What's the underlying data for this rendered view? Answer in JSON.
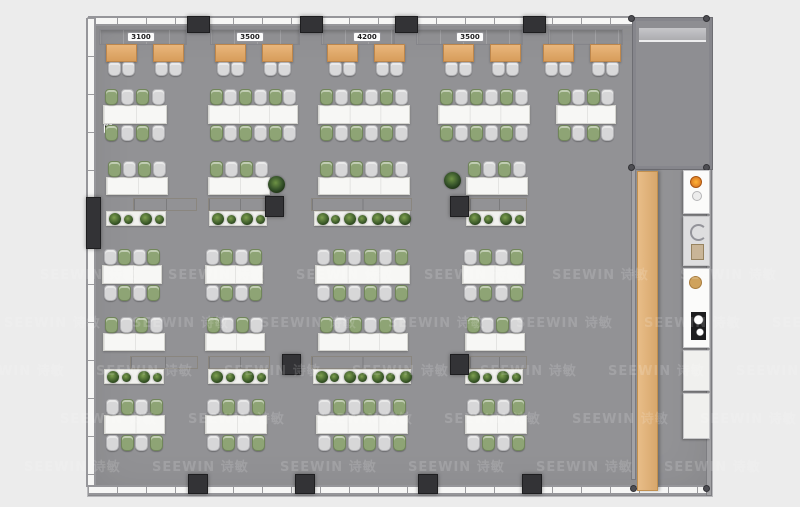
{
  "watermark": {
    "text": "SEEWIN 诗敏",
    "color": "#ffffff",
    "opacity": 0.15,
    "grid": {
      "rows": 5,
      "cols": 7,
      "x0": 40,
      "y0": 264,
      "dx": 128,
      "dy": 48,
      "row_shift": -36
    }
  },
  "floorplan": {
    "dim_labels": {
      "top": [
        "3100",
        "3500",
        "4200",
        "3500"
      ],
      "left": "7800"
    },
    "colors": {
      "page_bg": "#ececec",
      "floor": "#929295",
      "booth_wood": "#dfa76c",
      "chair_green": "#8ea475",
      "chair_gray": "#d7d7d8",
      "desk_white": "#f7f7f5",
      "storage_panel": "#a8a49e",
      "column_dark": "#333336",
      "plant_green": "#3f5e2b",
      "wood_bar": "#ddab72"
    },
    "layout": {
      "dim_top_cx": [
        53,
        162,
        279,
        382
      ],
      "benches": [
        {
          "x": 11,
          "w": 88
        },
        {
          "x": 122,
          "w": 90
        },
        {
          "x": 233,
          "w": 74
        },
        {
          "x": 328,
          "w": 107
        },
        {
          "x": 460,
          "w": 75
        }
      ],
      "booths": {
        "xs": [
          18,
          65,
          127,
          174,
          239,
          286,
          355,
          402,
          455,
          502
        ],
        "y": 26
      },
      "bands": [
        {
          "type": "cluster",
          "y": 71,
          "double": true,
          "start": "green",
          "items": [
            {
              "x": 15,
              "w": 64,
              "seats": 4
            },
            {
              "x": 120,
              "w": 90,
              "seats": 6
            },
            {
              "x": 230,
              "w": 92,
              "seats": 6
            },
            {
              "x": 350,
              "w": 92,
              "seats": 6
            },
            {
              "x": 468,
              "w": 60,
              "seats": 4
            }
          ]
        },
        {
          "type": "cluster",
          "y": 143,
          "double": false,
          "start": "green",
          "items": [
            {
              "x": 18,
              "w": 62,
              "seats": 4
            },
            {
              "x": 120,
              "w": 62,
              "seats": 4
            },
            {
              "x": 230,
              "w": 92,
              "seats": 6
            },
            {
              "x": 378,
              "w": 62,
              "seats": 4
            }
          ]
        },
        {
          "type": "storage",
          "y": 179,
          "items": [
            {
              "px": 45,
              "pw": 64,
              "qx": 18,
              "qw": 60
            },
            {
              "px": 120,
              "pw": 62,
              "qx": 121,
              "qw": 58,
              "dark": [
                177
              ]
            },
            {
              "px": 223,
              "pw": 101,
              "qx": 226,
              "qw": 96
            },
            {
              "px": 381,
              "pw": 58,
              "qx": 378,
              "qw": 60,
              "dark": [
                362
              ]
            }
          ]
        },
        {
          "type": "cluster",
          "y": 231,
          "double": true,
          "start": "gray",
          "items": [
            {
              "x": 14,
              "w": 60,
              "seats": 4
            },
            {
              "x": 117,
              "w": 58,
              "seats": 4
            },
            {
              "x": 227,
              "w": 95,
              "seats": 6
            },
            {
              "x": 374,
              "w": 63,
              "seats": 4
            }
          ]
        },
        {
          "type": "cluster",
          "y": 299,
          "double": false,
          "start": "green",
          "items": [
            {
              "x": 15,
              "w": 62,
              "seats": 4
            },
            {
              "x": 117,
              "w": 60,
              "seats": 4
            },
            {
              "x": 230,
              "w": 90,
              "seats": 6
            },
            {
              "x": 377,
              "w": 60,
              "seats": 4
            }
          ]
        },
        {
          "type": "storage",
          "y": 337,
          "items": [
            {
              "px": 42,
              "pw": 68,
              "qx": 16,
              "qw": 60
            },
            {
              "px": 120,
              "pw": 62,
              "qx": 120,
              "qw": 60,
              "dark": [
                194
              ]
            },
            {
              "px": 223,
              "pw": 101,
              "qx": 225,
              "qw": 98
            },
            {
              "px": 381,
              "pw": 58,
              "qx": 377,
              "qw": 58,
              "dark": [
                362
              ]
            }
          ]
        },
        {
          "type": "cluster",
          "y": 381,
          "double": true,
          "start": "gray",
          "items": [
            {
              "x": 16,
              "w": 61,
              "seats": 4
            },
            {
              "x": 117,
              "w": 62,
              "seats": 4
            },
            {
              "x": 228,
              "w": 92,
              "seats": 6
            },
            {
              "x": 377,
              "w": 62,
              "seats": 4
            }
          ]
        }
      ],
      "trees": [
        {
          "x": 180,
          "y": 158
        },
        {
          "x": 356,
          "y": 154
        }
      ],
      "columns": {
        "top": [
          99,
          212,
          307,
          435
        ],
        "bottom": [
          100,
          207,
          330,
          434
        ],
        "left": [
          {
            "x": -2,
            "y": 179,
            "w": 15,
            "h": 52
          }
        ]
      },
      "appliances": [
        {
          "y": 152,
          "h": 44,
          "kind": "cooktop"
        },
        {
          "y": 198,
          "h": 50,
          "kind": "sink"
        },
        {
          "y": 250,
          "h": 80,
          "kind": "coffee"
        },
        {
          "y": 332,
          "h": 41,
          "kind": "cabinet"
        },
        {
          "y": 375,
          "h": 46,
          "kind": "cabinet"
        }
      ]
    }
  }
}
